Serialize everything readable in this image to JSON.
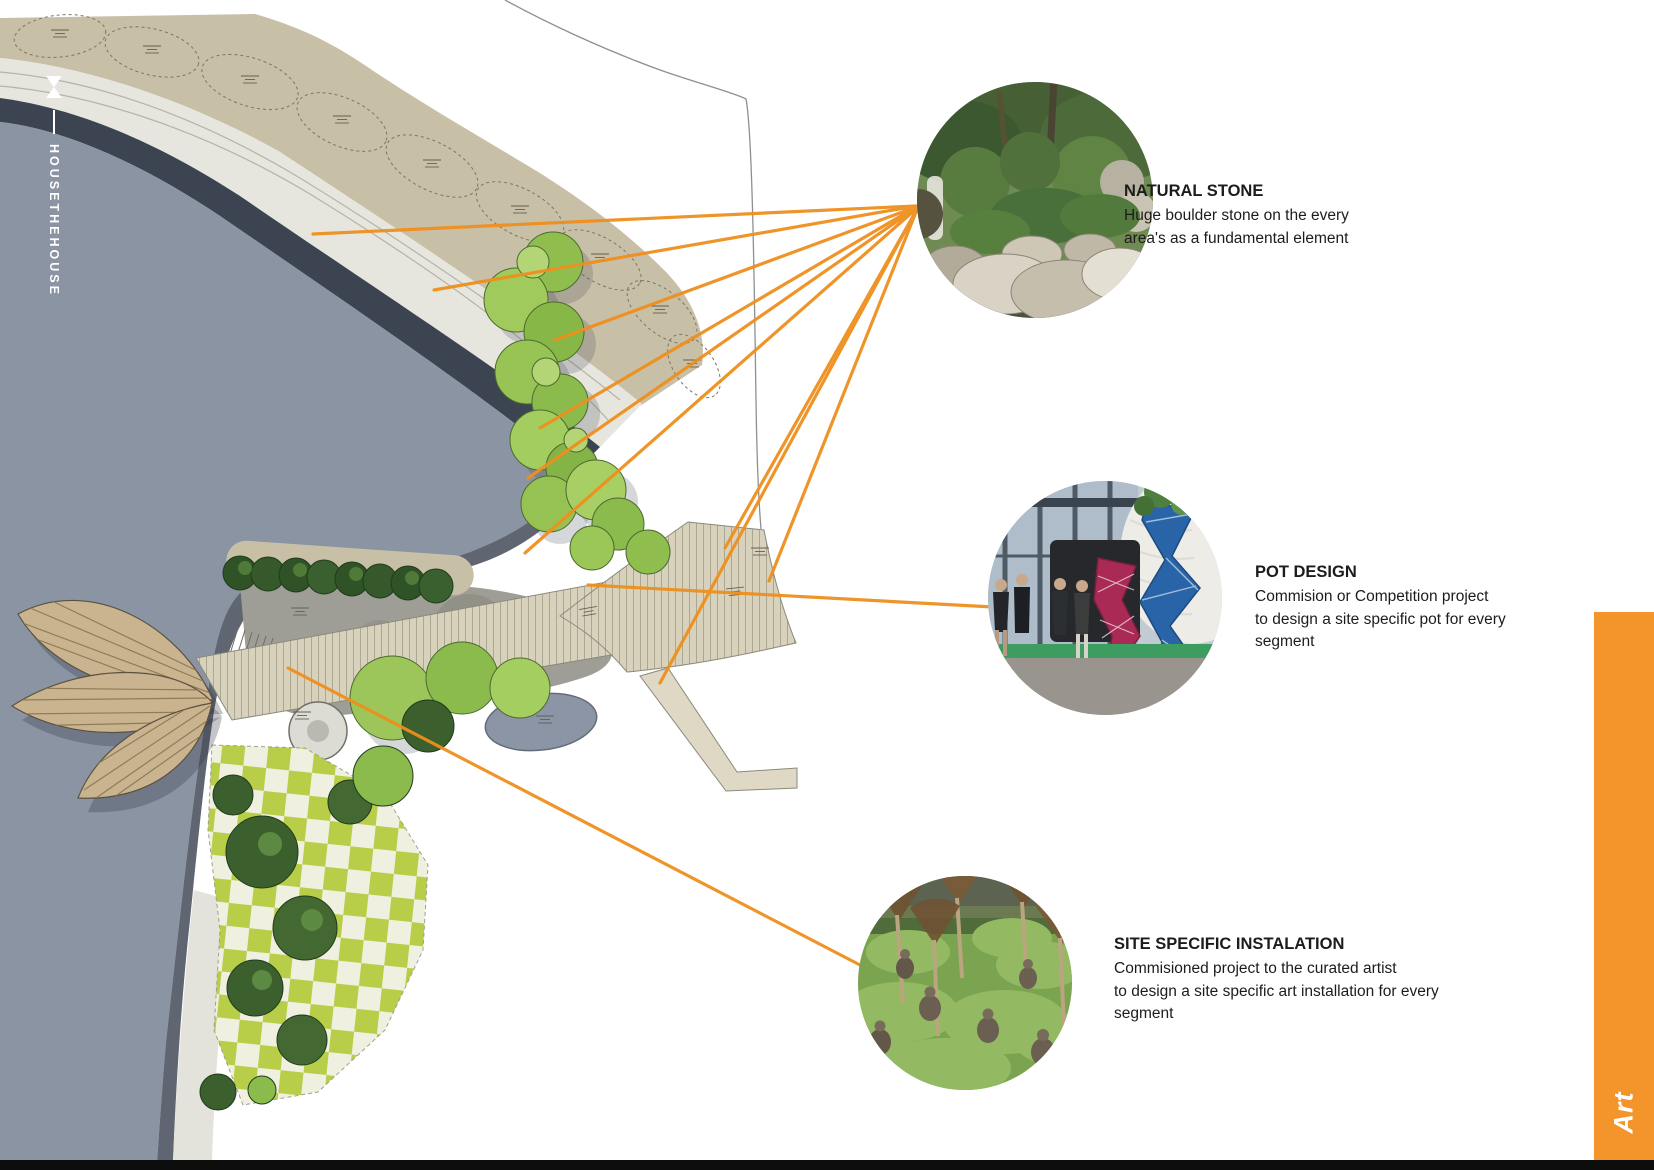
{
  "brand": {
    "icon": "bowtie-icon",
    "name": "HOUSETHEHOUSE"
  },
  "side_tab": {
    "label": "Art"
  },
  "colors": {
    "accent_orange": "#EF8F1D",
    "tab_orange": "#F3952B",
    "lake_blue_gray": "#8A94A3"
  },
  "callouts": [
    {
      "id": "natural-stone",
      "title": "NATURAL STONE",
      "lines": [
        "Huge boulder stone on the every",
        "area's as a fundamental element"
      ]
    },
    {
      "id": "pot-design",
      "title": "POT DESIGN",
      "lines": [
        "Commision or Competition project",
        "to design a site specific pot for every",
        "segment"
      ]
    },
    {
      "id": "site-specific-instalation",
      "title": "SITE SPECIFIC INSTALATION",
      "lines": [
        "Commisioned project to the curated artist",
        "to design a site specific art installation for every",
        "segment"
      ]
    }
  ],
  "photos": [
    {
      "name": "natural-stone-photo",
      "subject": "japanese garden with huge boulders"
    },
    {
      "name": "pot-design-photo",
      "subject": "exhibition hall with sculptural pots"
    },
    {
      "name": "site-installation-photo",
      "subject": "lawn mounds with seated figures under trees"
    }
  ]
}
